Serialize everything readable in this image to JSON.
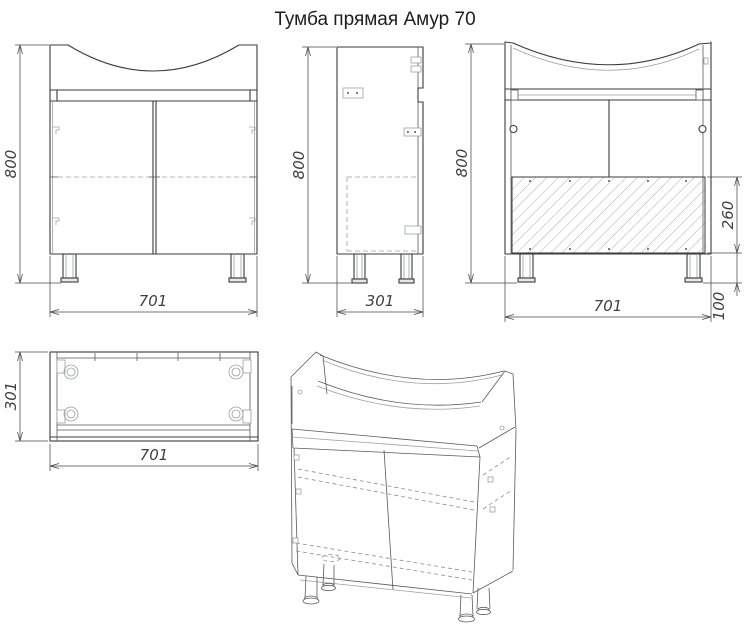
{
  "title": "Тумба прямая Амур 70",
  "dimensions": {
    "front": {
      "height": "800",
      "width": "701"
    },
    "side": {
      "height": "800",
      "depth": "301"
    },
    "back": {
      "height": "800",
      "width": "701",
      "back_panel_height": "260",
      "leg_height": "100"
    },
    "top": {
      "depth": "301",
      "width": "701"
    }
  },
  "colors": {
    "background": "#ffffff",
    "outline": "#3b3b3b",
    "dimension_lines": "#4a4a4a",
    "hidden_lines": "#9aa0a3",
    "hatch": "#8b8b8b"
  },
  "views": {
    "front": "front-elevation",
    "side": "side-elevation",
    "back": "rear-elevation-with-back-panel-hatch",
    "top": "plan-view",
    "iso": "isometric-view"
  }
}
